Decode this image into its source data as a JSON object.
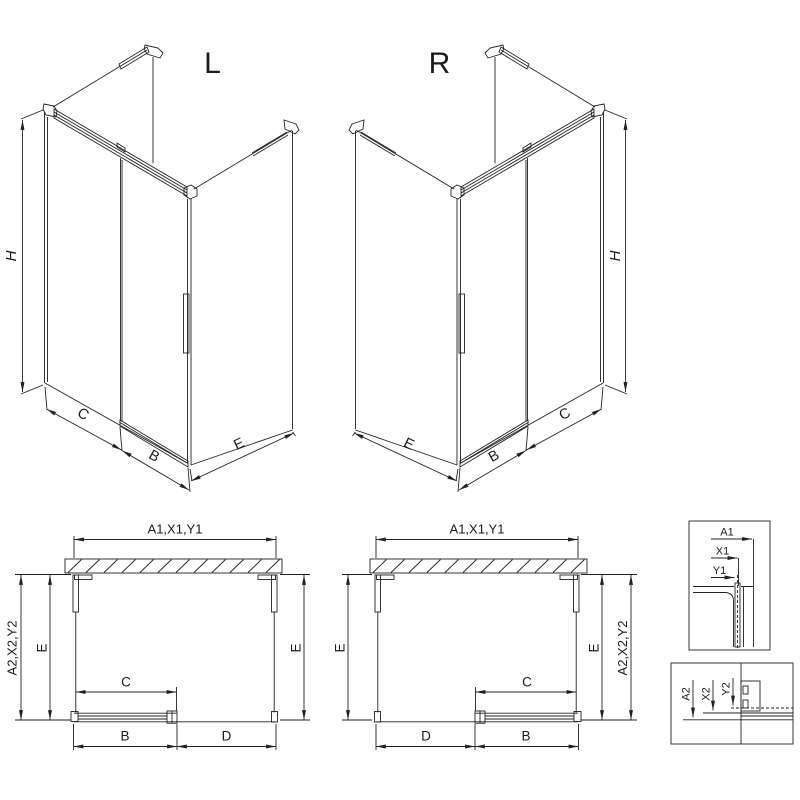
{
  "drawing": {
    "kind": "shower-enclosure-technical-drawing",
    "variants": {
      "left": "L",
      "right": "R"
    },
    "labels": {
      "h": "H",
      "c": "C",
      "b": "B",
      "d": "D",
      "e": "E",
      "a1x1y1": "A1,X1,Y1",
      "a2x2y2": "A2,X2,Y2",
      "a1": "A1",
      "x1": "X1",
      "y1": "Y1",
      "a2": "A2",
      "x2": "X2",
      "y2": "Y2"
    },
    "colors": {
      "line": "#222222",
      "glass_edge": "#a8a8a8",
      "track_fill": "#b8b8b8",
      "background": "#ffffff"
    }
  }
}
